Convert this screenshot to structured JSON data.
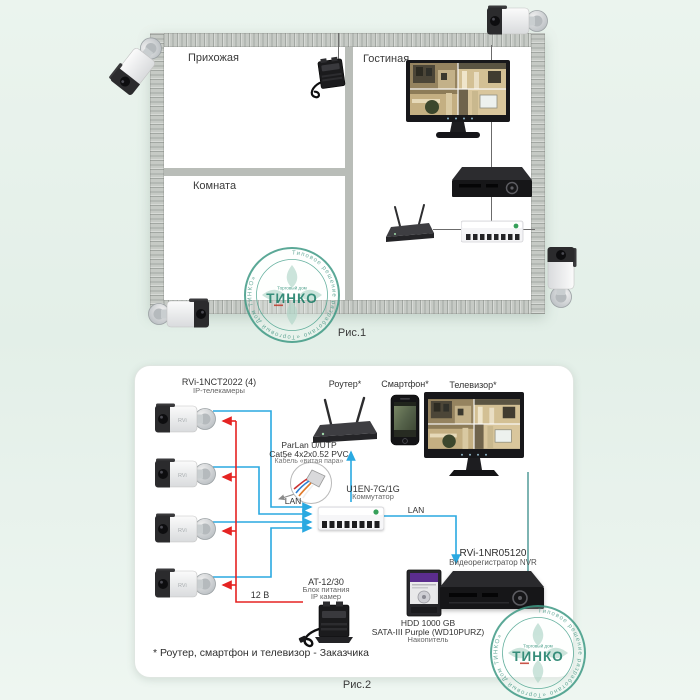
{
  "figure1": {
    "caption": "Рис.1",
    "room_hall": "Прихожая",
    "room_living": "Гостиная",
    "room_room": "Комната"
  },
  "figure2": {
    "caption": "Рис.2",
    "cameras_model": "RVi-1NCT2022 (4)",
    "cameras_sub": "IP-телекамеры",
    "router_label": "Роутер*",
    "smartphone_label": "Смартфон*",
    "tv_label": "Телевизор*",
    "cable_model": "ParLan U/UTP",
    "cable_spec": "Cat5e 4x2x0.52 PVC",
    "cable_sub": "Кабель «витая пара»",
    "lan_label": "LAN",
    "switch_model": "U1EN-7G/1G",
    "switch_sub": "Коммутатор",
    "nvr_model": "RVi-1NR05120",
    "nvr_sub": "Видеорегистратор NVR",
    "hdd_model": "HDD 1000 GB",
    "hdd_spec": "SATA-III Purple (WD10PURZ)",
    "hdd_sub": "Накопитель",
    "psu_model": "AT-12/30",
    "psu_sub1": "Блок питания",
    "psu_sub2": "IP камер",
    "power_label": "12 В",
    "footnote": "* Роутер, смартфон и телевизор - Заказчика"
  },
  "stamp": {
    "ring_text": "Типовое решение разработано «Торговый Дом ТИНКО»",
    "brand_top": "Торговый дом",
    "brand": "ТИНКО"
  },
  "device_logos": {
    "camera": "RVi"
  },
  "colors": {
    "lan_line": "#2aa9e1",
    "power_line": "#e52322",
    "tv_link_line": "#7db4b2",
    "stamp_teal": "#2f9078",
    "switch_logo_green": "#36a05a"
  }
}
